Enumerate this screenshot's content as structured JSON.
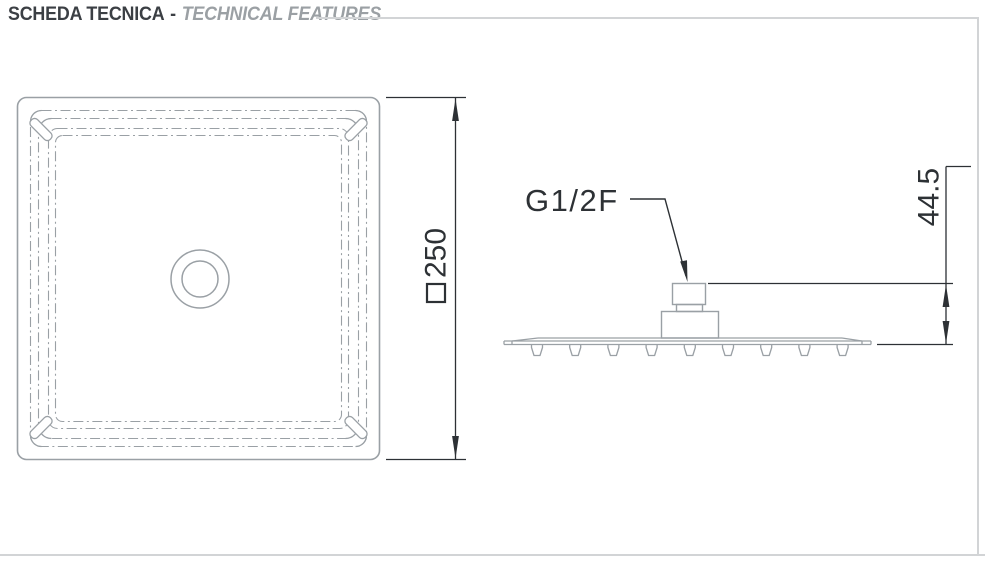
{
  "header": {
    "title_primary": "SCHEDA TECNICA",
    "separator": "-",
    "title_secondary": "TECHNICAL FEATURES"
  },
  "drawing": {
    "top_view": {
      "view": "top view of square shower head",
      "dimension_value": "250",
      "dimension_symbol": "square-outline"
    },
    "side_view": {
      "view": "side view of shower head",
      "connection_label": "G1/2F",
      "height_dimension_value": "44.5",
      "nozzle_count": 9
    }
  },
  "colors": {
    "background": "#ffffff",
    "outline_gray": "#9aa0a5",
    "dimension_dark": "#2d3135",
    "title_dark": "#3b3f44",
    "title_gray": "#9ba0a4",
    "border_gray": "#d2d4d6"
  }
}
